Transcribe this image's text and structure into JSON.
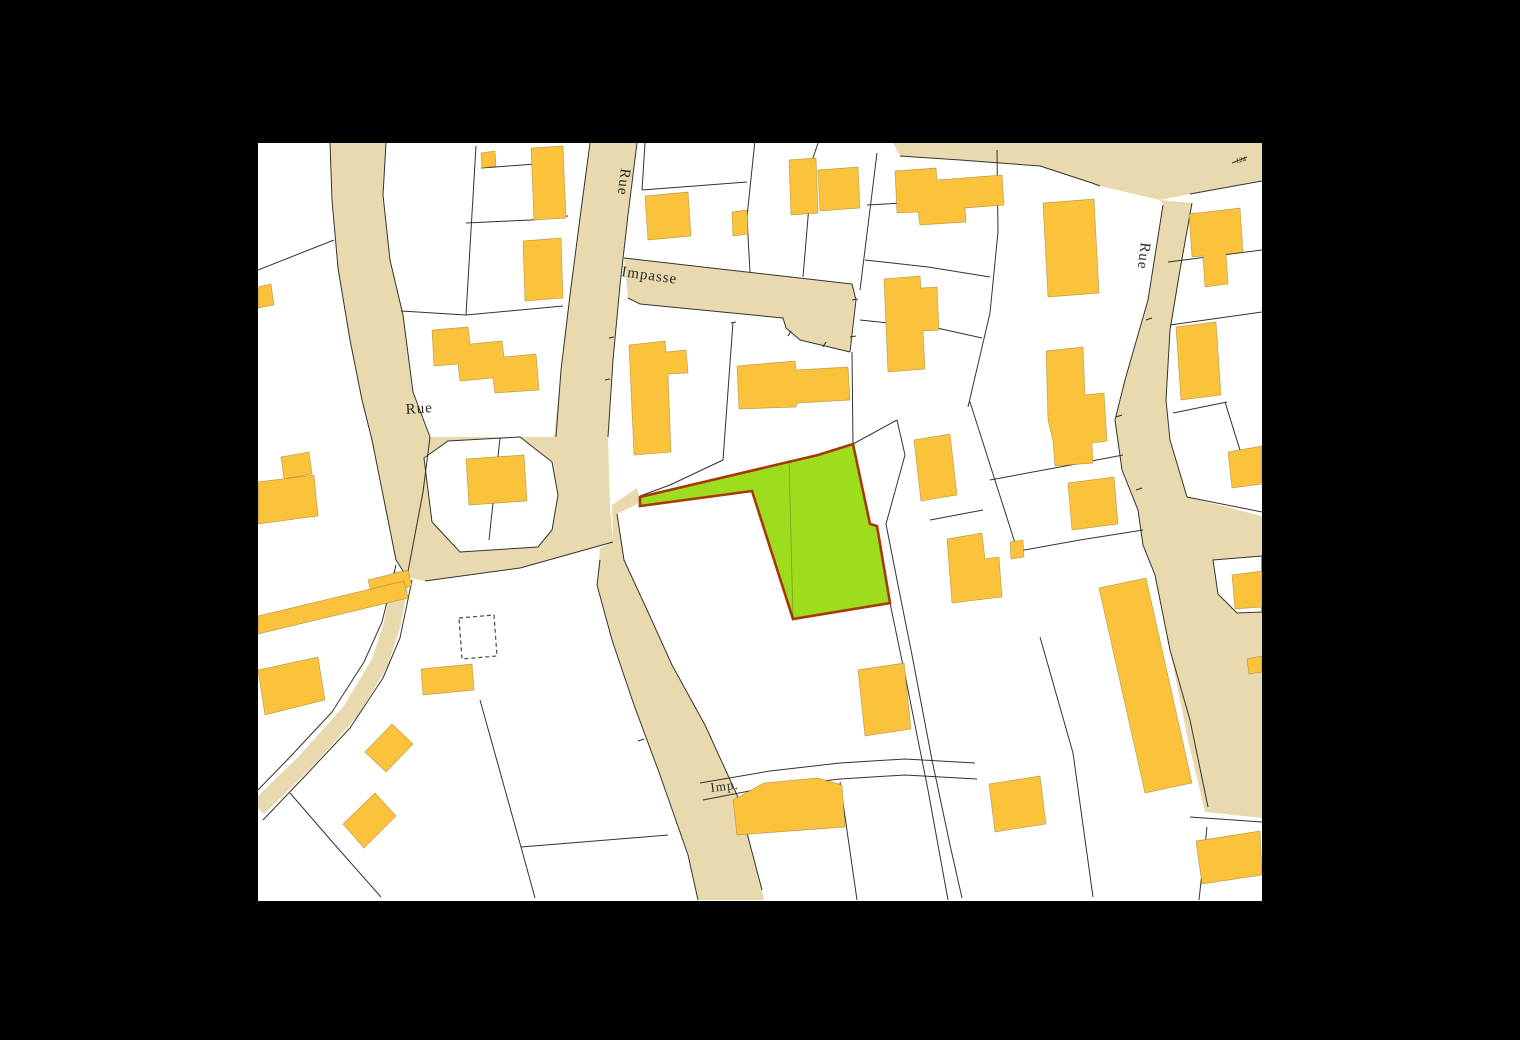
{
  "app": {
    "type": "cadastral-map-viewer"
  },
  "canvas": {
    "width": 1520,
    "height": 1040,
    "background": "#000000"
  },
  "map": {
    "x": 258,
    "y": 143,
    "width": 1004,
    "height": 758,
    "background": "#ffffff"
  },
  "colors": {
    "road": "#e9d9ae",
    "parcel_line": "#35332c",
    "building": "#fbc33c",
    "building_border": "#8a6f2a",
    "selected_fill": "#9edc1e",
    "selected_stroke": "#a53a08",
    "label": "#2b2a24",
    "tiny_label": "#6b675c",
    "dashed_building": "#4a473f"
  },
  "labels": [
    {
      "name": "road-name-rue-top",
      "text": "Rue",
      "x": 621,
      "y": 168,
      "rotate": 97,
      "size": 15
    },
    {
      "name": "road-name-impasse",
      "text": "Impasse",
      "x": 621,
      "y": 276,
      "rotate": 8,
      "size": 15
    },
    {
      "name": "road-name-rue-left",
      "text": "Rue",
      "x": 406,
      "y": 414,
      "rotate": -4,
      "size": 15
    },
    {
      "name": "road-name-rue-right",
      "text": "Rue",
      "x": 1141,
      "y": 242,
      "rotate": 97,
      "size": 15
    },
    {
      "name": "road-name-imp",
      "text": "Imp.",
      "x": 711,
      "y": 792,
      "rotate": -7,
      "size": 13
    },
    {
      "name": "parcel-number-124",
      "text": "124",
      "x": 1236,
      "y": 163,
      "rotate": -10,
      "size": 7,
      "tiny": true
    }
  ],
  "roads": {
    "polygons": [
      {
        "name": "road-rue-left",
        "points": "330,143 386,143 383,195 390,260 403,315 413,392 430,437 423,492 413,545 407,577 396,560 385,505 372,440 362,400 350,340 338,268 332,200"
      },
      {
        "name": "road-rue-center",
        "points": "590,143 637,143 628,215 620,285 613,360 608,437 554,437 561,370 570,295 580,218"
      },
      {
        "name": "road-junction",
        "points": "430,437 608,437 610,507 613,542 520,568 425,581 407,577 413,545 423,492"
      },
      {
        "name": "road-south",
        "points": "600,548 613,542 612,505 637,488 641,502 617,514 624,560 648,612 672,665 705,725 737,795 762,890 764,900 698,900 688,855 660,775 634,705 612,640 597,585"
      },
      {
        "name": "road-impasse",
        "points": "624,258 852,284 856,300 850,352 800,340 786,328 783,318 640,304 628,298"
      },
      {
        "name": "road-top-right",
        "points": "893,143 1262,143 1262,181 1190,194 1160,200 1100,186 1040,166 960,160 900,156"
      },
      {
        "name": "road-rue-right",
        "points": "1160,200 1192,203 1180,270 1170,330 1166,400 1170,440 1187,497 1262,516 1262,818 1205,812 1188,740 1170,650 1155,575 1143,545 1138,510 1122,470 1115,420 1125,380 1148,300 1163,205"
      }
    ],
    "lane": {
      "name": "road-lane-southwest",
      "points": "402,572 392,625 380,662 350,712 305,762 258,808",
      "width": 17
    }
  },
  "white_overlays": [
    {
      "name": "parcel-island",
      "points": "424,458 448,441 520,437 552,462 558,495 552,530 538,547 460,552 432,522"
    },
    {
      "name": "parcel-notch-right",
      "points": "1213,560 1262,556 1262,612 1237,613 1218,594"
    }
  ],
  "parcel_edges": [
    "590,143 580,218 570,295 561,370 556,437",
    "637,143 628,215 620,285 613,360 608,437",
    "624,258 852,284",
    "628,298 640,304 783,318 786,328 800,340 850,352",
    "852,284 856,300 850,352",
    "330,143 332,200 338,268 350,340 362,400 372,440 385,505 396,560 407,577",
    "386,143 383,195 390,260 403,315 413,392 430,437",
    "430,437 423,492 413,545 407,577",
    "613,542 520,568 425,581",
    "600,560 597,585 612,640 634,705 660,775 688,855 698,900",
    "617,514 624,560 648,612 672,665 705,725 737,795 762,890",
    "900,156 960,160 1040,166 1092,183 1100,186",
    "1190,194 1262,181",
    "1163,205 1148,300 1125,380 1115,420 1122,470 1138,510 1143,545 1155,575 1170,650 1190,720 1208,807",
    "1192,203 1180,270 1170,330 1166,400 1170,440 1187,497",
    "1187,497 1262,512",
    "1190,817 1262,822",
    "1207,827 1199,900",
    "890,603 906,680 928,790 948,900",
    "886,524 898,585 912,655 932,760 950,845 962,898",
    "897,420 905,455 886,524",
    "853,444 897,420",
    "852,352 853,444",
    "733,322 723,460 670,485 640,496",
    "755,140 747,217 750,272",
    "818,143 813,158 803,277",
    "877,153 860,290",
    "642,190 747,182",
    "645,143 642,190",
    "867,205 920,202 998,196",
    "997,150 998,232 990,313 968,407",
    "865,260 928,267 990,277",
    "860,320 937,328 982,338",
    "970,402 1015,543",
    "930,520 983,510",
    "990,480 1060,467 1123,455",
    "1013,552 1080,540 1143,530",
    "1173,413 1227,402",
    "1225,402 1240,450",
    "1168,262 1262,250",
    "1170,325 1262,312",
    "476,146 466,315",
    "466,315 401,311",
    "466,315 563,306",
    "481,168 563,162",
    "466,223 531,220 568,216",
    "258,270 334,240",
    "500,438 489,540",
    "480,700 521,847 535,898",
    "521,847 668,835",
    "290,793 335,845 381,897",
    "700,783 770,771 840,763 905,759 975,763",
    "703,800 770,787 840,779 905,775 977,779",
    "840,782 857,900",
    "1040,637 1073,753",
    "1073,753 1093,897",
    "396,565 382,622 364,662 332,712 290,757 258,790",
    "412,580 400,638 383,678 350,728 306,775 263,820",
    "1232,163 1247,157"
  ],
  "ticks": [
    "638,741 644,739",
    "1146,320 1152,318",
    "1136,490 1142,488",
    "1116,417 1122,415",
    "852,300 858,299",
    "850,337 856,336",
    "788,336 791,331",
    "823,347 826,342",
    "731,323 736,322",
    "609,338 614,337",
    "605,380 610,379"
  ],
  "buildings": [
    "481,153 495,151 496,166 482,168",
    "531,148 563,146 566,218 534,220",
    "523,241 561,238 563,298 525,301",
    "432,330 468,327 470,344 502,341 504,357 536,354 539,390 495,393 493,378 460,381 458,364 434,366",
    "466,459 524,455 527,501 469,505",
    "368,580 408,570 412,586 372,596",
    "258,616 404,581 408,598 258,634",
    "281,457 309,452 312,474 284,479",
    "258,482 314,475 318,516 258,524",
    "258,287 271,284 274,305 258,308",
    "645,196 688,192 691,236 648,240",
    "732,212 747,210 748,234 733,236",
    "789,160 816,158 818,213 791,215",
    "818,170 858,167 860,208 820,211",
    "895,171 936,168 937,180 1002,175 1004,205 965,208 966,222 920,225 918,212 897,213",
    "884,279 920,276 921,288 937,287 939,330 923,331 925,369 888,372",
    "1043,203 1094,199 1099,293 1048,297",
    "1046,351 1083,347 1085,395 1104,393 1107,441 1092,443 1093,463 1055,466 1053,441 1048,420",
    "1189,214 1240,208 1243,252 1226,254 1228,284 1205,287 1203,256 1192,257",
    "1176,327 1216,322 1221,395 1181,400",
    "1228,452 1262,446 1262,484 1232,488",
    "914,440 950,434 957,495 921,501",
    "947,539 982,533 985,559 999,557 1002,597 952,603",
    "1010,542 1023,540 1024,557 1011,559",
    "1068,483 1114,477 1118,524 1072,530",
    "1099,588 1146,578 1192,783 1145,793",
    "989,784 1040,776 1046,824 995,832",
    "733,800 764,783 818,778 842,785 845,827 737,835",
    "858,670 904,663 911,729 865,736",
    "365,752 392,724 413,744 386,772",
    "343,824 375,793 396,816 364,848",
    "258,670 318,657 325,700 265,715",
    "1196,841 1260,831 1262,875 1202,884",
    "1247,659 1262,656 1262,672 1249,674",
    "421,669 472,664 474,690 423,695",
    "629,345 665,341 666,352 686,350 688,373 668,374 671,452 634,455",
    "737,366 795,361 796,370 848,367 850,400 797,403 796,407 739,409",
    "1232,575 1262,571 1262,607 1235,609"
  ],
  "dashed_buildings": [
    "459,618 494,615 497,656 462,659"
  ],
  "selected_parcel": {
    "name": "selected-parcel-highlight",
    "points": "640,497 818,455 853,444 870,524 877,526 890,603 793,619 752,491 640,506",
    "inner_line": "789,459 793,618"
  }
}
